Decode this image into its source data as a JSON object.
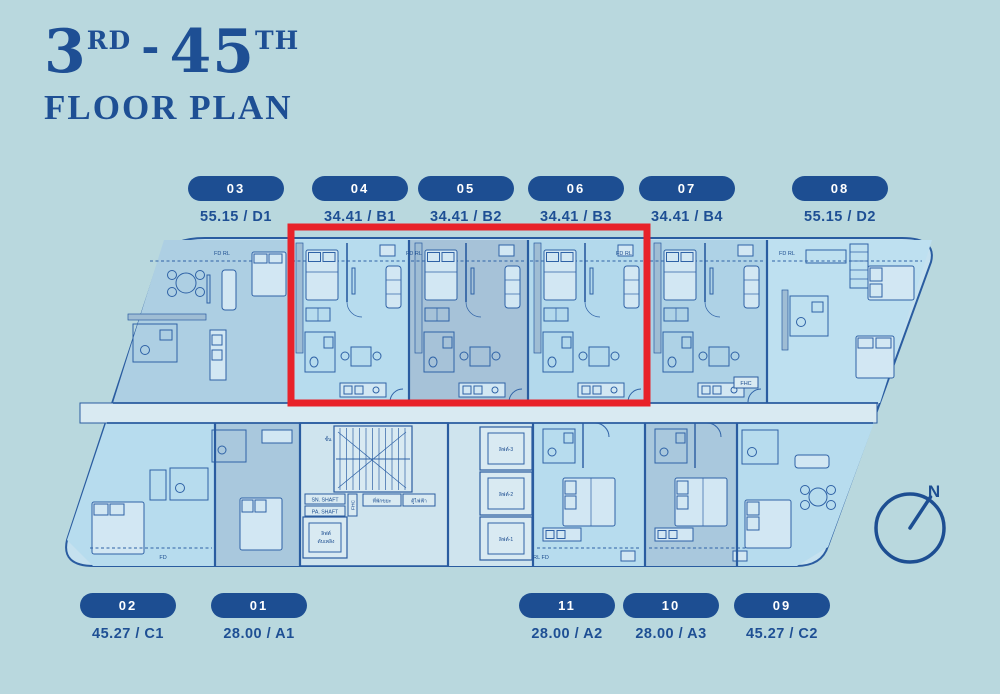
{
  "title": {
    "range_start": "3",
    "range_start_suffix": "RD",
    "separator": "-",
    "range_end": "45",
    "range_end_suffix": "TH",
    "subtitle": "FLOOR PLAN"
  },
  "units_top": [
    {
      "number": "03",
      "area": "55.15 / D1"
    },
    {
      "number": "04",
      "area": "34.41 / B1"
    },
    {
      "number": "05",
      "area": "34.41 / B2"
    },
    {
      "number": "06",
      "area": "34.41 / B3"
    },
    {
      "number": "07",
      "area": "34.41 / B4"
    },
    {
      "number": "08",
      "area": "55.15 / D2"
    }
  ],
  "units_bottom": [
    {
      "number": "02",
      "area": "45.27 / C1"
    },
    {
      "number": "01",
      "area": "28.00 / A1"
    },
    {
      "number": "11",
      "area": "28.00 / A2"
    },
    {
      "number": "10",
      "area": "28.00 / A3"
    },
    {
      "number": "09",
      "area": "45.27 / C2"
    }
  ],
  "plan": {
    "fd_rl": "FD RL",
    "rl_fd": "RL FD",
    "fd": "FD",
    "fhc": "FHC",
    "sn_shaft": "SN. SHAFT",
    "pa_shaft": "PA. SHAFT",
    "stair_label": "ชั้น",
    "fire_lift_line1": "ลิฟต์",
    "fire_lift_line2": "ดับเพลิง",
    "garbage_room": "ที่พักขยะ",
    "electrical": "ตู้ไฟฟ้า",
    "lift_1": "ลิฟต์-1",
    "lift_2": "ลิฟต์-2",
    "lift_3": "ลิฟต์-3"
  },
  "compass": {
    "label": "N"
  },
  "colors": {
    "background": "#b9d8de",
    "accent_blue": "#1d4e92",
    "wall_blue": "#2a5ca0",
    "highlight_red": "#e8222a"
  }
}
